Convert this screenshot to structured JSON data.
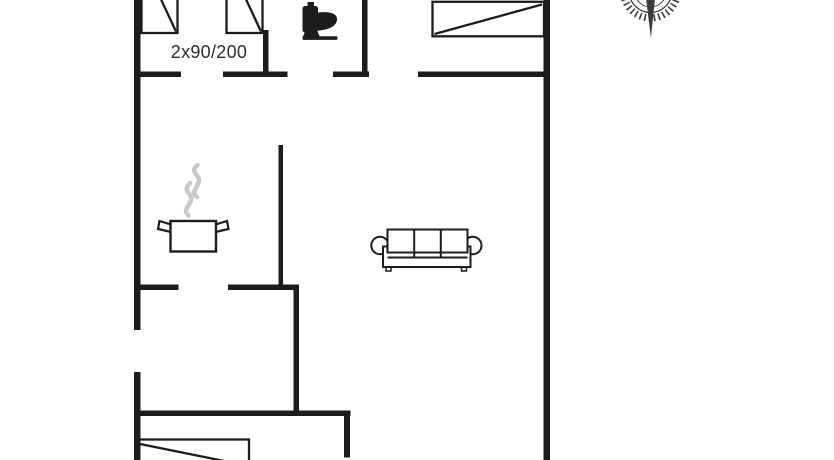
{
  "colors": {
    "ink": "#1c1c1c",
    "steam": "#c9c9c9",
    "label": "#2d2d2d",
    "compass": "#3c3c3c",
    "background": "#ffffff"
  },
  "floorplan": {
    "bed_label": "2x90/200",
    "icons": {
      "toilet": "toilet-side-silhouette",
      "stove": "steaming-pot",
      "sofa": "three-seat-sofa-top-view",
      "beds": "bed-with-diagonal-fold",
      "compass": "compass-rose-south-needle"
    }
  }
}
